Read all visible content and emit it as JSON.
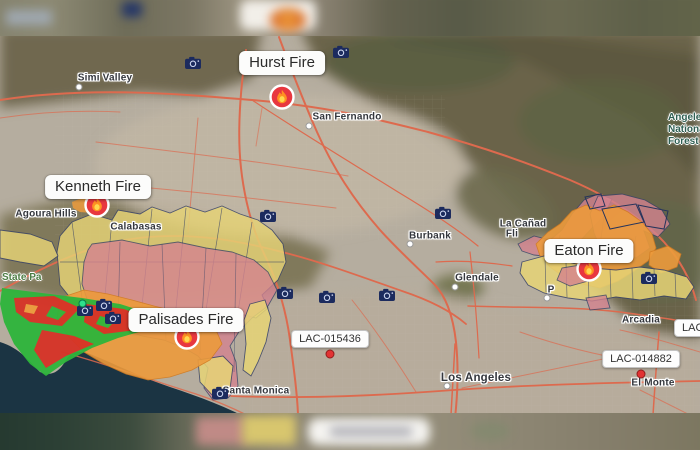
{
  "map_title": "Wildfire incident map - Los Angeles area",
  "colors": {
    "evacuation_warning": "#e7d476",
    "evacuation_order": "#d4838f",
    "fire_perimeter": "#ed9b3c",
    "damage_destroyed": "#d63226",
    "damage_undamaged": "#2eb53b",
    "zone_outline": "#3a4467",
    "road": "#dd6a4e",
    "ocean": "#1b3443",
    "camera_icon": "#1c2b5e",
    "fire_icon_red": "#e8373f",
    "flame_orange": "#ff9022",
    "flame_yellow": "#ffd84d"
  },
  "fires": [
    {
      "name": "Hurst Fire",
      "label_x": 282,
      "label_y": 63,
      "icon_x": 282,
      "icon_y": 97
    },
    {
      "name": "Kenneth Fire",
      "label_x": 98,
      "label_y": 187,
      "icon_x": 97,
      "icon_y": 205
    },
    {
      "name": "Palisades Fire",
      "label_x": 186,
      "label_y": 320,
      "icon_x": 187,
      "icon_y": 337
    },
    {
      "name": "Eaton Fire",
      "label_x": 589,
      "label_y": 251,
      "icon_x": 589,
      "icon_y": 269
    }
  ],
  "incident_labels": [
    {
      "id": "LAC-015436",
      "x": 330,
      "y": 339,
      "marker_x": 330,
      "marker_y": 354,
      "partial": false
    },
    {
      "id": "LAC-014882",
      "x": 641,
      "y": 359,
      "marker_x": 641,
      "marker_y": 374,
      "partial": false
    },
    {
      "id": "LAC-",
      "x": 674,
      "y": 328,
      "partial": true
    }
  ],
  "cities": [
    {
      "name": "Simi Valley",
      "x": 105,
      "y": 78,
      "dot": true,
      "dot_x": 79,
      "dot_y": 87,
      "major": false
    },
    {
      "name": "San Fernando",
      "x": 347,
      "y": 117,
      "dot": true,
      "dot_x": 309,
      "dot_y": 126,
      "major": false
    },
    {
      "name": "Burbank",
      "x": 430,
      "y": 236,
      "dot": true,
      "dot_x": 410,
      "dot_y": 244,
      "major": false
    },
    {
      "name": "Glendale",
      "x": 477,
      "y": 278,
      "dot": true,
      "dot_x": 455,
      "dot_y": 287,
      "major": false
    },
    {
      "name": "P",
      "x": 551,
      "y": 290,
      "dot": true,
      "dot_x": 547,
      "dot_y": 298,
      "major": false
    },
    {
      "name": "Los Angeles",
      "x": 476,
      "y": 378,
      "dot": true,
      "dot_x": 447,
      "dot_y": 386,
      "major": true
    },
    {
      "name": "Santa Monica",
      "x": 256,
      "y": 391,
      "dot": false,
      "major": false
    },
    {
      "name": "El Monte",
      "x": 653,
      "y": 383,
      "dot": false,
      "major": false
    },
    {
      "name": "Arcadia",
      "x": 641,
      "y": 320,
      "dot": false,
      "major": false
    },
    {
      "name": "Calabasas",
      "x": 136,
      "y": 227,
      "dot": false,
      "major": false
    },
    {
      "name": "Agoura Hills",
      "x": 46,
      "y": 214,
      "dot": false,
      "major": false
    },
    {
      "name": "La Cañad",
      "x": 523,
      "y": 224,
      "dot": false,
      "major": false
    },
    {
      "name": "Fli",
      "x": 512,
      "y": 234,
      "dot": false,
      "major": false
    }
  ],
  "areas": [
    {
      "name": "Angeles National Forest",
      "x": 668,
      "y": 112,
      "w": 72,
      "color": "#2f5f53"
    },
    {
      "name": "State Pa",
      "x": 2,
      "y": 272,
      "w": 60,
      "color": "#4c7c44"
    }
  ],
  "cameras": [
    {
      "x": 193,
      "y": 63,
      "status_dot": false
    },
    {
      "x": 341,
      "y": 52,
      "status_dot": false
    },
    {
      "x": 268,
      "y": 216,
      "status_dot": false
    },
    {
      "x": 443,
      "y": 213,
      "status_dot": false
    },
    {
      "x": 285,
      "y": 293,
      "status_dot": false
    },
    {
      "x": 327,
      "y": 297,
      "status_dot": false
    },
    {
      "x": 387,
      "y": 295,
      "status_dot": false
    },
    {
      "x": 85,
      "y": 310,
      "status_dot": true
    },
    {
      "x": 104,
      "y": 305,
      "status_dot": false
    },
    {
      "x": 113,
      "y": 318,
      "status_dot": false
    },
    {
      "x": 220,
      "y": 393,
      "status_dot": false
    },
    {
      "x": 649,
      "y": 278,
      "status_dot": false
    }
  ]
}
